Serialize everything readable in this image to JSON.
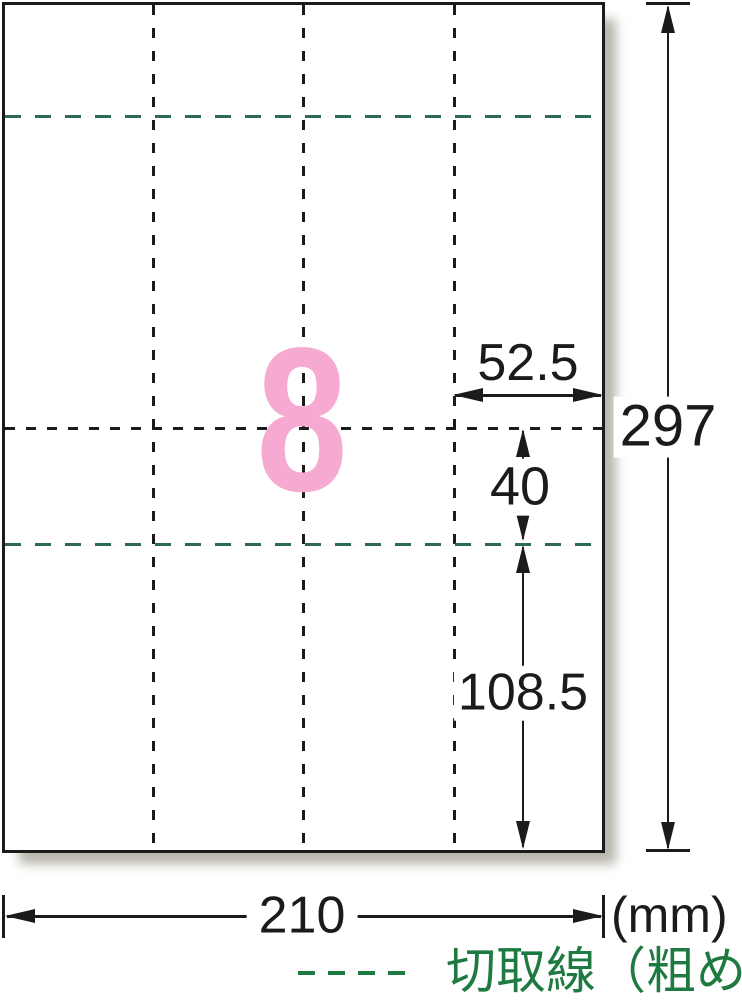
{
  "colors": {
    "line-black": "#1b1b1b",
    "cut-line-green": "#2d6b52",
    "legend-green": "#1e7a40",
    "count-pink": "#f6a9d1"
  },
  "sheet": {
    "count": "8"
  },
  "dims": {
    "cell_width": "52.5",
    "gap": "40",
    "bottom": "108.5",
    "height": "297",
    "width": "210",
    "unit": "(mm)"
  },
  "legend": {
    "label": "切取線（粗め）"
  }
}
